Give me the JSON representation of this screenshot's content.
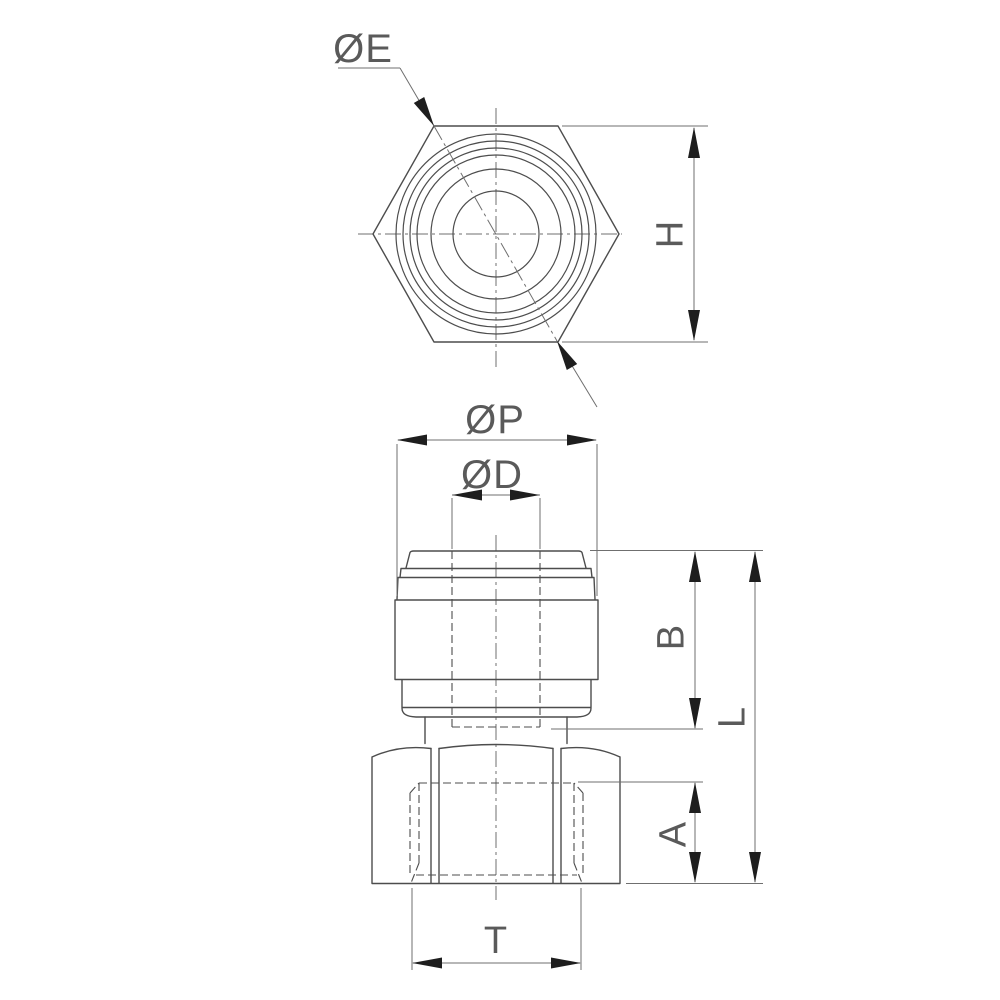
{
  "colors": {
    "background": "#ffffff",
    "outline": "#4d4d4d",
    "thin_line": "#6f6f6f",
    "arrow": "#1e1e1e",
    "text": "#5a5a5a"
  },
  "top_view": {
    "diameter_label": "ØE",
    "height_label": "H"
  },
  "front_view": {
    "outer_diameter_label": "ØP",
    "tube_diameter_label": "ØD",
    "body_height_label": "B",
    "overall_length_label": "L",
    "thread_depth_label": "A",
    "thread_width_label": "T"
  }
}
